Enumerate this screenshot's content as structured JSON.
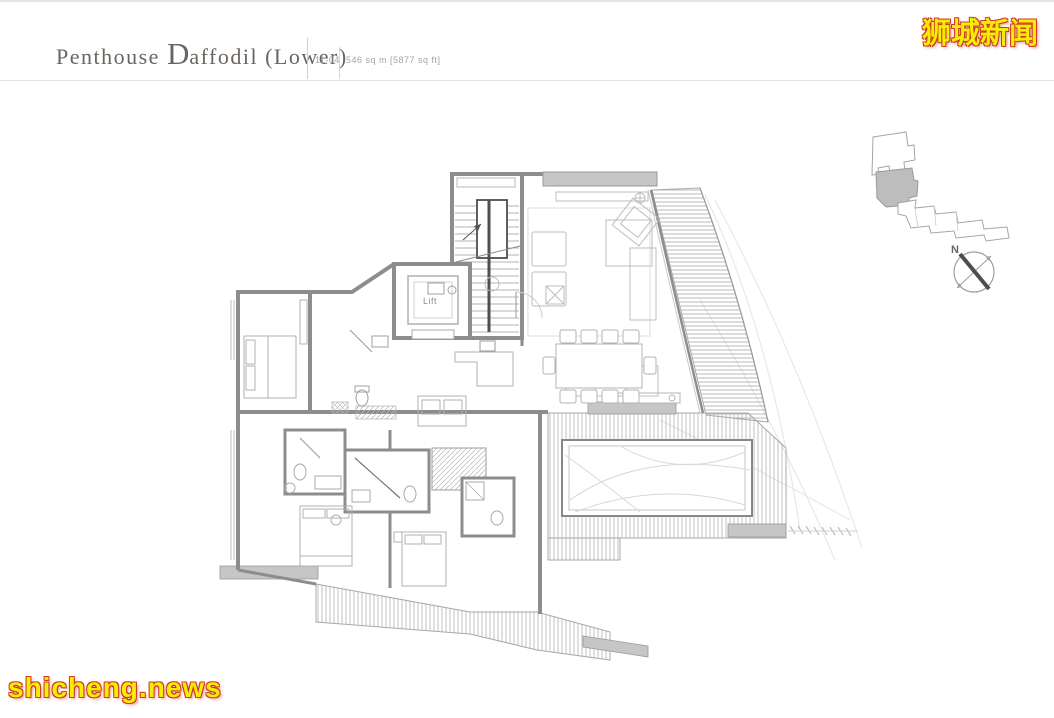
{
  "header": {
    "title_prefix": "Penthouse ",
    "title_initial": "D",
    "title_rest": "affodil (Lower)",
    "unit_number": "11-04",
    "area_text": "546 sq m [5877 sq ft]"
  },
  "watermarks": {
    "top_right_text": "狮城新闻",
    "bottom_left_text": "shicheng.news",
    "text_color": "#f6ee00",
    "outline_color": "#cf3a28"
  },
  "floor_plan": {
    "lift_label": "Lift",
    "compass_label": "N",
    "wall_color": "#8d8d8d",
    "furniture_color": "#b9b9b9",
    "deck_hatch_color": "#b0b0b0",
    "keyplan_unit_fill": "#bdbdbd"
  }
}
